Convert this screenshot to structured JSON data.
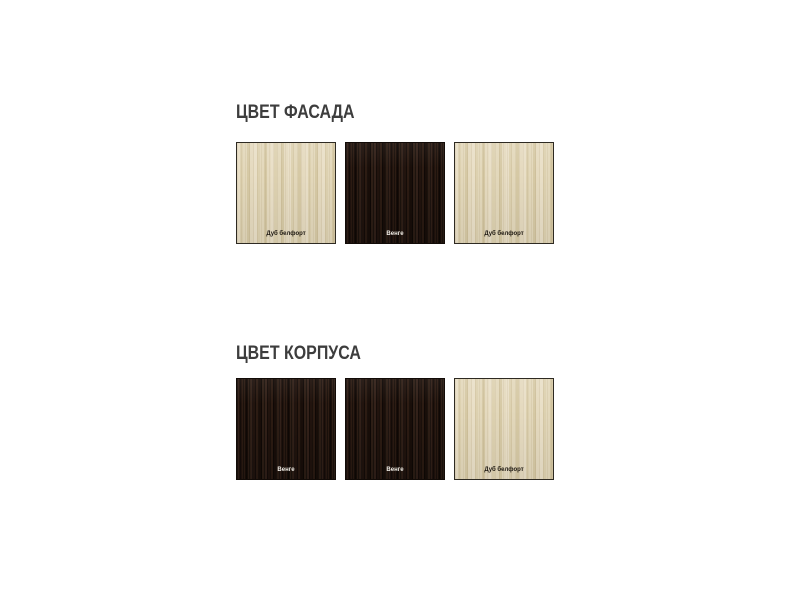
{
  "page": {
    "background": "#ffffff"
  },
  "sections": [
    {
      "title": "ЦВЕТ ФАСАДА",
      "swatches": [
        {
          "label": "Дуб белфорт",
          "type": "light",
          "material_color": "#ddd2b2"
        },
        {
          "label": "Венге",
          "type": "dark",
          "material_color": "#281a11"
        },
        {
          "label": "Дуб белфорт",
          "type": "light",
          "material_color": "#ddd2b2"
        }
      ]
    },
    {
      "title": "ЦВЕТ КОРПУСА",
      "swatches": [
        {
          "label": "Венге",
          "type": "dark",
          "material_color": "#281a11"
        },
        {
          "label": "Венге",
          "type": "dark",
          "material_color": "#281a11"
        },
        {
          "label": "Дуб белфорт",
          "type": "light",
          "material_color": "#ddd2b2"
        }
      ]
    }
  ],
  "colors": {
    "title_text": "#3d3d3d",
    "light_wood_base": "#ddd2b2",
    "dark_wood_base": "#281a11",
    "label_on_light": "#1c1710",
    "label_on_dark": "#f2efe8",
    "swatch_border_light": "#2e2a22",
    "swatch_border_dark": "#120b07"
  }
}
